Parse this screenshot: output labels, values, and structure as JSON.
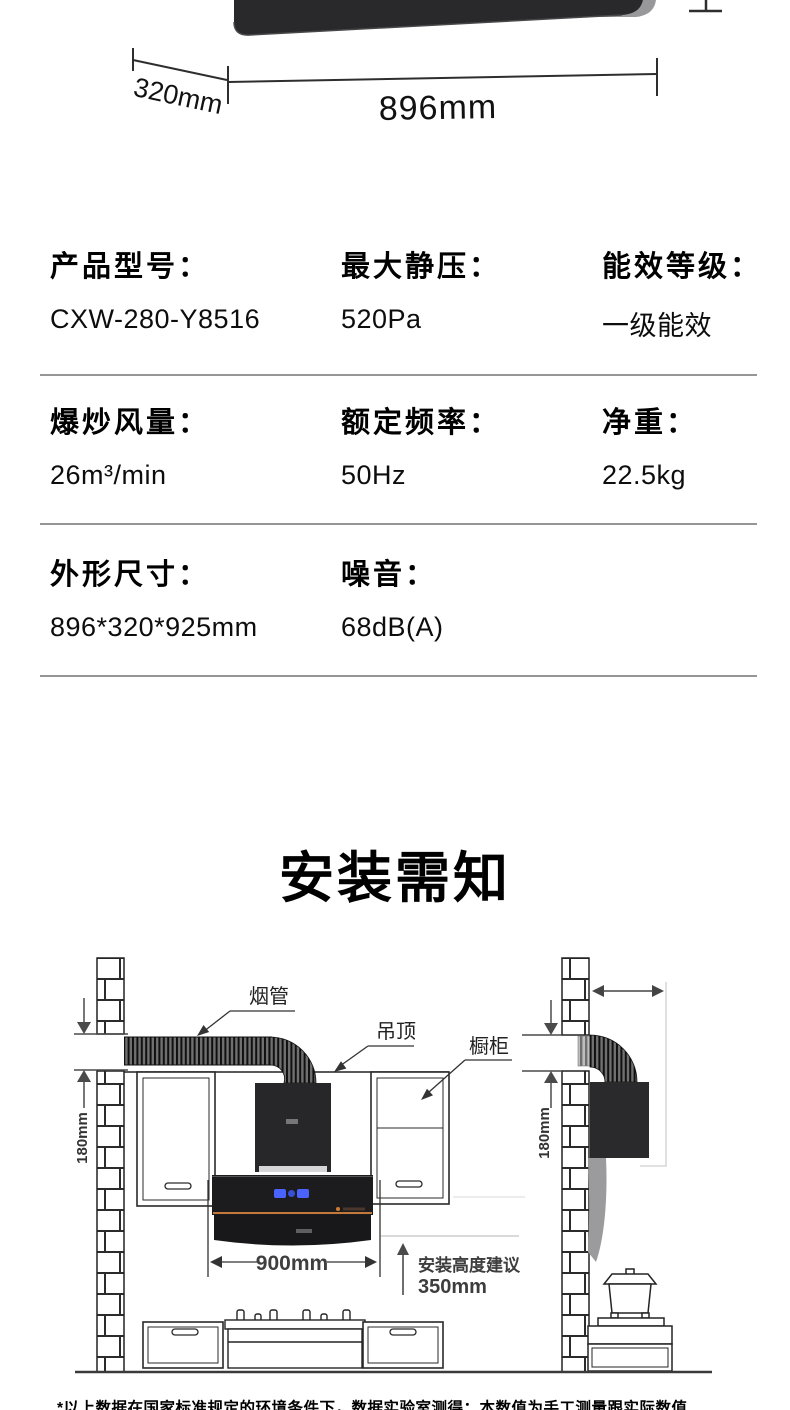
{
  "hero": {
    "depth_label": "320mm",
    "width_label": "896mm"
  },
  "specs": {
    "rows": [
      {
        "cells": [
          {
            "label": "产品型号：",
            "value": "CXW-280-Y8516"
          },
          {
            "label": "最大静压：",
            "value": "520Pa"
          },
          {
            "label": "能效等级：",
            "value": "一级能效"
          }
        ]
      },
      {
        "cells": [
          {
            "label": "爆炒风量：",
            "value": "26m³/min"
          },
          {
            "label": "额定频率：",
            "value": "50Hz"
          },
          {
            "label": "净重：",
            "value": "22.5kg"
          }
        ]
      },
      {
        "cells": [
          {
            "label": "外形尺寸：",
            "value": "896*320*925mm"
          },
          {
            "label": "噪音：",
            "value": "68dB(A)"
          }
        ]
      }
    ]
  },
  "install": {
    "title": "安装需知",
    "labels": {
      "pipe": "烟管",
      "ceiling": "吊顶",
      "cabinet": "橱柜",
      "gap_left": "180mm",
      "gap_right": "180mm",
      "hood_width": "900mm",
      "height_note_line1": "安装高度建议",
      "height_note_line2": "350mm"
    }
  },
  "footnote": {
    "text": "*以上数据在国家标准规定的环境条件下，数据实验室测得：本数值为手工测量跟实际数值"
  },
  "colors": {
    "hood_accent": "#c2793b",
    "display_blue": "#4a63ff",
    "hood_black": "#232326",
    "divider_gray": "#969696"
  }
}
